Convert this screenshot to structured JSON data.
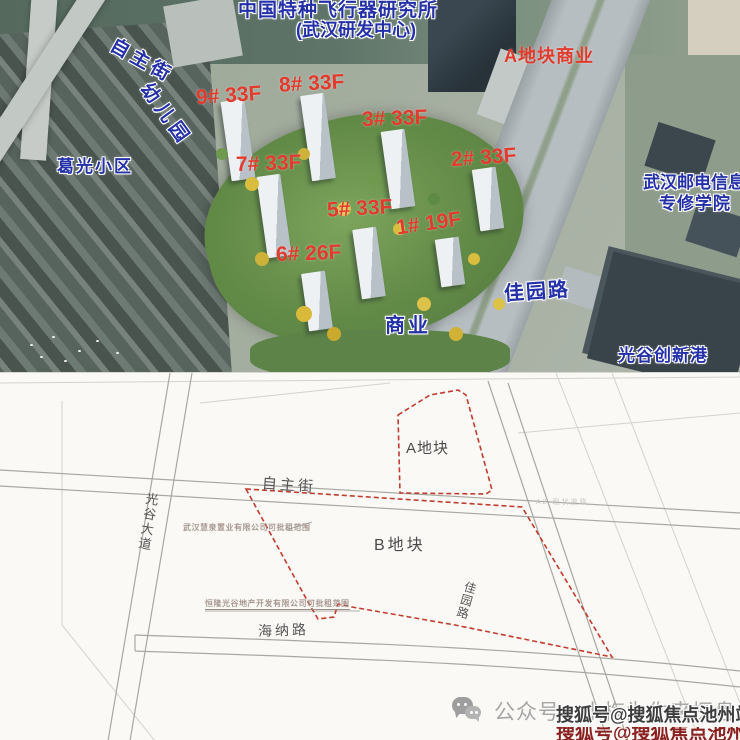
{
  "aerial": {
    "institute": {
      "line1": "中国特种飞行器研究所",
      "line2": "(武汉研发中心)"
    },
    "streets": {
      "zizhu": "自主街",
      "jiayuan": "佳园路"
    },
    "places": {
      "kindergarten": "幼儿园",
      "geguang": "葛光小区",
      "plot_a_commercial": "A地块商业",
      "college_line1": "武汉邮电信息",
      "college_line2": "专修学院",
      "commercial": "商业",
      "innovation_port": "光谷创新港"
    },
    "buildings": [
      {
        "label": "9# 33F"
      },
      {
        "label": "8# 33F"
      },
      {
        "label": "3# 33F"
      },
      {
        "label": "2# 33F"
      },
      {
        "label": "7# 33F"
      },
      {
        "label": "5# 33F"
      },
      {
        "label": "1# 19F"
      },
      {
        "label": "6# 26F"
      }
    ]
  },
  "siteplan": {
    "plots": {
      "a": "A地块",
      "b": "B地块"
    },
    "roads": {
      "zizhu": "自主街",
      "guanggu": "光谷大道",
      "jiayuan": "佳园路",
      "haina": "海纳路"
    },
    "notes": {
      "note1": "武汉慧泉置业有限公司可批租范围",
      "note2": "恒隆光谷地产开发有限公司可批租范围",
      "note3": "A2 现状道路"
    }
  },
  "footer": {
    "wechat_label": "公众号：小梅为你来探盘",
    "watermark": "搜狐号@搜狐焦点池州站"
  },
  "colors": {
    "building_label": "#e23a2c",
    "place_label": "#2430a8",
    "plot_boundary": "#c23b2e"
  }
}
